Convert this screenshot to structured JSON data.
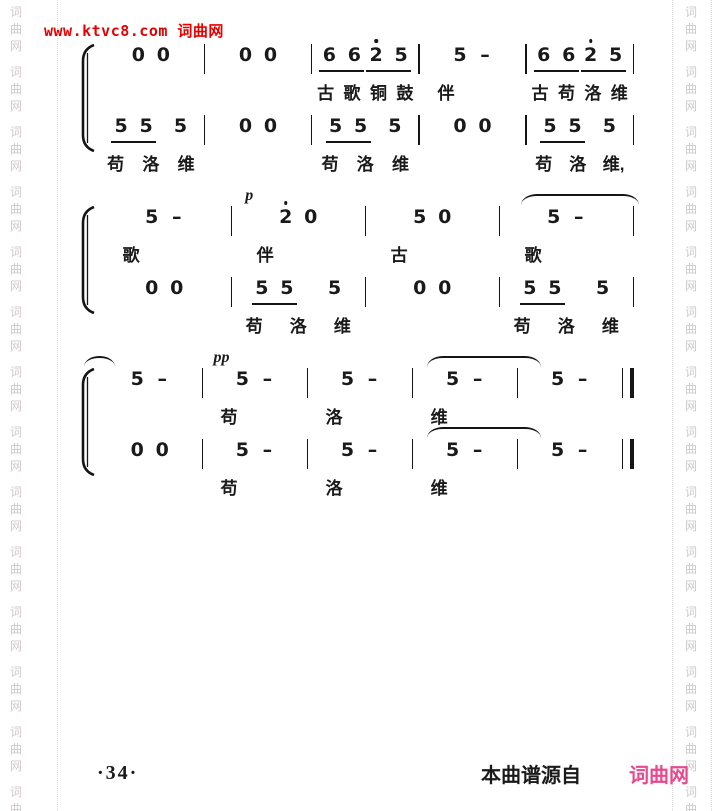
{
  "page": {
    "watermark_text": "www.ktvc8.com 词曲网",
    "watermark_color": "#e60000",
    "ink_color": "#1a1a1a",
    "border": {
      "chars": [
        "词",
        "曲",
        "网"
      ],
      "group_count": 14,
      "char_color": "#cfc8c8"
    },
    "footer": {
      "page_number": "·34·",
      "source_prefix": "本曲谱源自",
      "source_site": "词曲网",
      "site_color": "#e8498e"
    }
  },
  "score": {
    "notation": "jianpu",
    "systems": [
      {
        "lines": [
          {
            "final": false,
            "measures": [
              {
                "groups": [
                  {
                    "underline": false,
                    "notes": [
                      {
                        "d": "0"
                      },
                      {
                        "d": "0"
                      }
                    ]
                  }
                ],
                "lyrics": []
              },
              {
                "groups": [
                  {
                    "underline": false,
                    "notes": [
                      {
                        "d": "0"
                      },
                      {
                        "d": "0"
                      }
                    ]
                  }
                ],
                "lyrics": []
              },
              {
                "groups": [
                  {
                    "underline": true,
                    "notes": [
                      {
                        "d": "6"
                      },
                      {
                        "d": "6"
                      }
                    ]
                  },
                  {
                    "underline": true,
                    "notes": [
                      {
                        "d": "2",
                        "octave_dot": true
                      },
                      {
                        "d": "5"
                      }
                    ]
                  }
                ],
                "lyrics": [
                  "古",
                  "歌",
                  "铜",
                  "鼓"
                ]
              },
              {
                "groups": [
                  {
                    "underline": false,
                    "notes": [
                      {
                        "d": "5"
                      },
                      {
                        "d": "-"
                      }
                    ]
                  }
                ],
                "lyrics": [
                  "伴"
                ]
              },
              {
                "groups": [
                  {
                    "underline": true,
                    "notes": [
                      {
                        "d": "6"
                      },
                      {
                        "d": "6"
                      }
                    ]
                  },
                  {
                    "underline": true,
                    "notes": [
                      {
                        "d": "2",
                        "octave_dot": true
                      },
                      {
                        "d": "5"
                      }
                    ]
                  }
                ],
                "lyrics": [
                  "古",
                  "苟",
                  "洛",
                  "维"
                ]
              }
            ]
          },
          {
            "final": false,
            "measures": [
              {
                "groups": [
                  {
                    "underline": true,
                    "notes": [
                      {
                        "d": "5"
                      },
                      {
                        "d": "5"
                      }
                    ]
                  },
                  {
                    "underline": false,
                    "notes": [
                      {
                        "d": "5"
                      }
                    ]
                  }
                ],
                "lyrics": [
                  "苟",
                  "洛",
                  "维"
                ]
              },
              {
                "groups": [
                  {
                    "underline": false,
                    "notes": [
                      {
                        "d": "0"
                      },
                      {
                        "d": "0"
                      }
                    ]
                  }
                ],
                "lyrics": []
              },
              {
                "groups": [
                  {
                    "underline": true,
                    "notes": [
                      {
                        "d": "5"
                      },
                      {
                        "d": "5"
                      }
                    ]
                  },
                  {
                    "underline": false,
                    "notes": [
                      {
                        "d": "5"
                      }
                    ]
                  }
                ],
                "lyrics": [
                  "苟",
                  "洛",
                  "维"
                ]
              },
              {
                "groups": [
                  {
                    "underline": false,
                    "notes": [
                      {
                        "d": "0"
                      },
                      {
                        "d": "0"
                      }
                    ]
                  }
                ],
                "lyrics": []
              },
              {
                "groups": [
                  {
                    "underline": true,
                    "notes": [
                      {
                        "d": "5"
                      },
                      {
                        "d": "5"
                      }
                    ]
                  },
                  {
                    "underline": false,
                    "notes": [
                      {
                        "d": "5"
                      }
                    ]
                  }
                ],
                "lyrics": [
                  "苟",
                  "洛",
                  "维,"
                ]
              }
            ]
          }
        ]
      },
      {
        "lines": [
          {
            "final": false,
            "measures": [
              {
                "groups": [
                  {
                    "underline": false,
                    "notes": [
                      {
                        "d": "5"
                      },
                      {
                        "d": "-"
                      }
                    ]
                  }
                ],
                "lyrics": [
                  "歌"
                ]
              },
              {
                "dynamic": "p",
                "groups": [
                  {
                    "underline": false,
                    "notes": [
                      {
                        "d": "2",
                        "octave_dot": true
                      },
                      {
                        "d": "0"
                      }
                    ]
                  }
                ],
                "lyrics": [
                  "伴"
                ]
              },
              {
                "groups": [
                  {
                    "underline": false,
                    "notes": [
                      {
                        "d": "5"
                      },
                      {
                        "d": "0"
                      }
                    ]
                  }
                ],
                "lyrics": [
                  "古"
                ]
              },
              {
                "tie": "out",
                "groups": [
                  {
                    "underline": false,
                    "notes": [
                      {
                        "d": "5"
                      },
                      {
                        "d": "-"
                      }
                    ]
                  }
                ],
                "lyrics": [
                  "歌"
                ]
              }
            ]
          },
          {
            "final": false,
            "measures": [
              {
                "groups": [
                  {
                    "underline": false,
                    "notes": [
                      {
                        "d": "0"
                      },
                      {
                        "d": "0"
                      }
                    ]
                  }
                ],
                "lyrics": []
              },
              {
                "groups": [
                  {
                    "underline": true,
                    "notes": [
                      {
                        "d": "5"
                      },
                      {
                        "d": "5"
                      }
                    ]
                  },
                  {
                    "underline": false,
                    "notes": [
                      {
                        "d": "5"
                      }
                    ]
                  }
                ],
                "lyrics": [
                  "苟",
                  "洛",
                  "维"
                ]
              },
              {
                "groups": [
                  {
                    "underline": false,
                    "notes": [
                      {
                        "d": "0"
                      },
                      {
                        "d": "0"
                      }
                    ]
                  }
                ],
                "lyrics": []
              },
              {
                "groups": [
                  {
                    "underline": true,
                    "notes": [
                      {
                        "d": "5"
                      },
                      {
                        "d": "5"
                      }
                    ]
                  },
                  {
                    "underline": false,
                    "notes": [
                      {
                        "d": "5"
                      }
                    ]
                  }
                ],
                "lyrics": [
                  "苟",
                  "洛",
                  "维"
                ]
              }
            ]
          }
        ]
      },
      {
        "lines": [
          {
            "final": true,
            "measures": [
              {
                "tie": "in",
                "groups": [
                  {
                    "underline": false,
                    "notes": [
                      {
                        "d": "5"
                      },
                      {
                        "d": "-"
                      }
                    ]
                  }
                ],
                "lyrics": []
              },
              {
                "dynamic": "pp",
                "groups": [
                  {
                    "underline": false,
                    "notes": [
                      {
                        "d": "5"
                      },
                      {
                        "d": "-"
                      }
                    ]
                  }
                ],
                "lyrics": [
                  "苟"
                ]
              },
              {
                "groups": [
                  {
                    "underline": false,
                    "notes": [
                      {
                        "d": "5"
                      },
                      {
                        "d": "-"
                      }
                    ]
                  }
                ],
                "lyrics": [
                  "洛"
                ]
              },
              {
                "tie": "span",
                "groups": [
                  {
                    "underline": false,
                    "notes": [
                      {
                        "d": "5"
                      },
                      {
                        "d": "-"
                      }
                    ]
                  }
                ],
                "lyrics": [
                  "维"
                ]
              },
              {
                "groups": [
                  {
                    "underline": false,
                    "notes": [
                      {
                        "d": "5"
                      },
                      {
                        "d": "-"
                      }
                    ]
                  }
                ],
                "lyrics": []
              }
            ]
          },
          {
            "final": true,
            "measures": [
              {
                "groups": [
                  {
                    "underline": false,
                    "notes": [
                      {
                        "d": "0"
                      },
                      {
                        "d": "0"
                      }
                    ]
                  }
                ],
                "lyrics": []
              },
              {
                "groups": [
                  {
                    "underline": false,
                    "notes": [
                      {
                        "d": "5"
                      },
                      {
                        "d": "-"
                      }
                    ]
                  }
                ],
                "lyrics": [
                  "苟"
                ]
              },
              {
                "groups": [
                  {
                    "underline": false,
                    "notes": [
                      {
                        "d": "5"
                      },
                      {
                        "d": "-"
                      }
                    ]
                  }
                ],
                "lyrics": [
                  "洛"
                ]
              },
              {
                "tie": "span",
                "groups": [
                  {
                    "underline": false,
                    "notes": [
                      {
                        "d": "5"
                      },
                      {
                        "d": "-"
                      }
                    ]
                  }
                ],
                "lyrics": [
                  "维"
                ]
              },
              {
                "groups": [
                  {
                    "underline": false,
                    "notes": [
                      {
                        "d": "5"
                      },
                      {
                        "d": "-"
                      }
                    ]
                  }
                ],
                "lyrics": []
              }
            ]
          }
        ]
      }
    ]
  }
}
